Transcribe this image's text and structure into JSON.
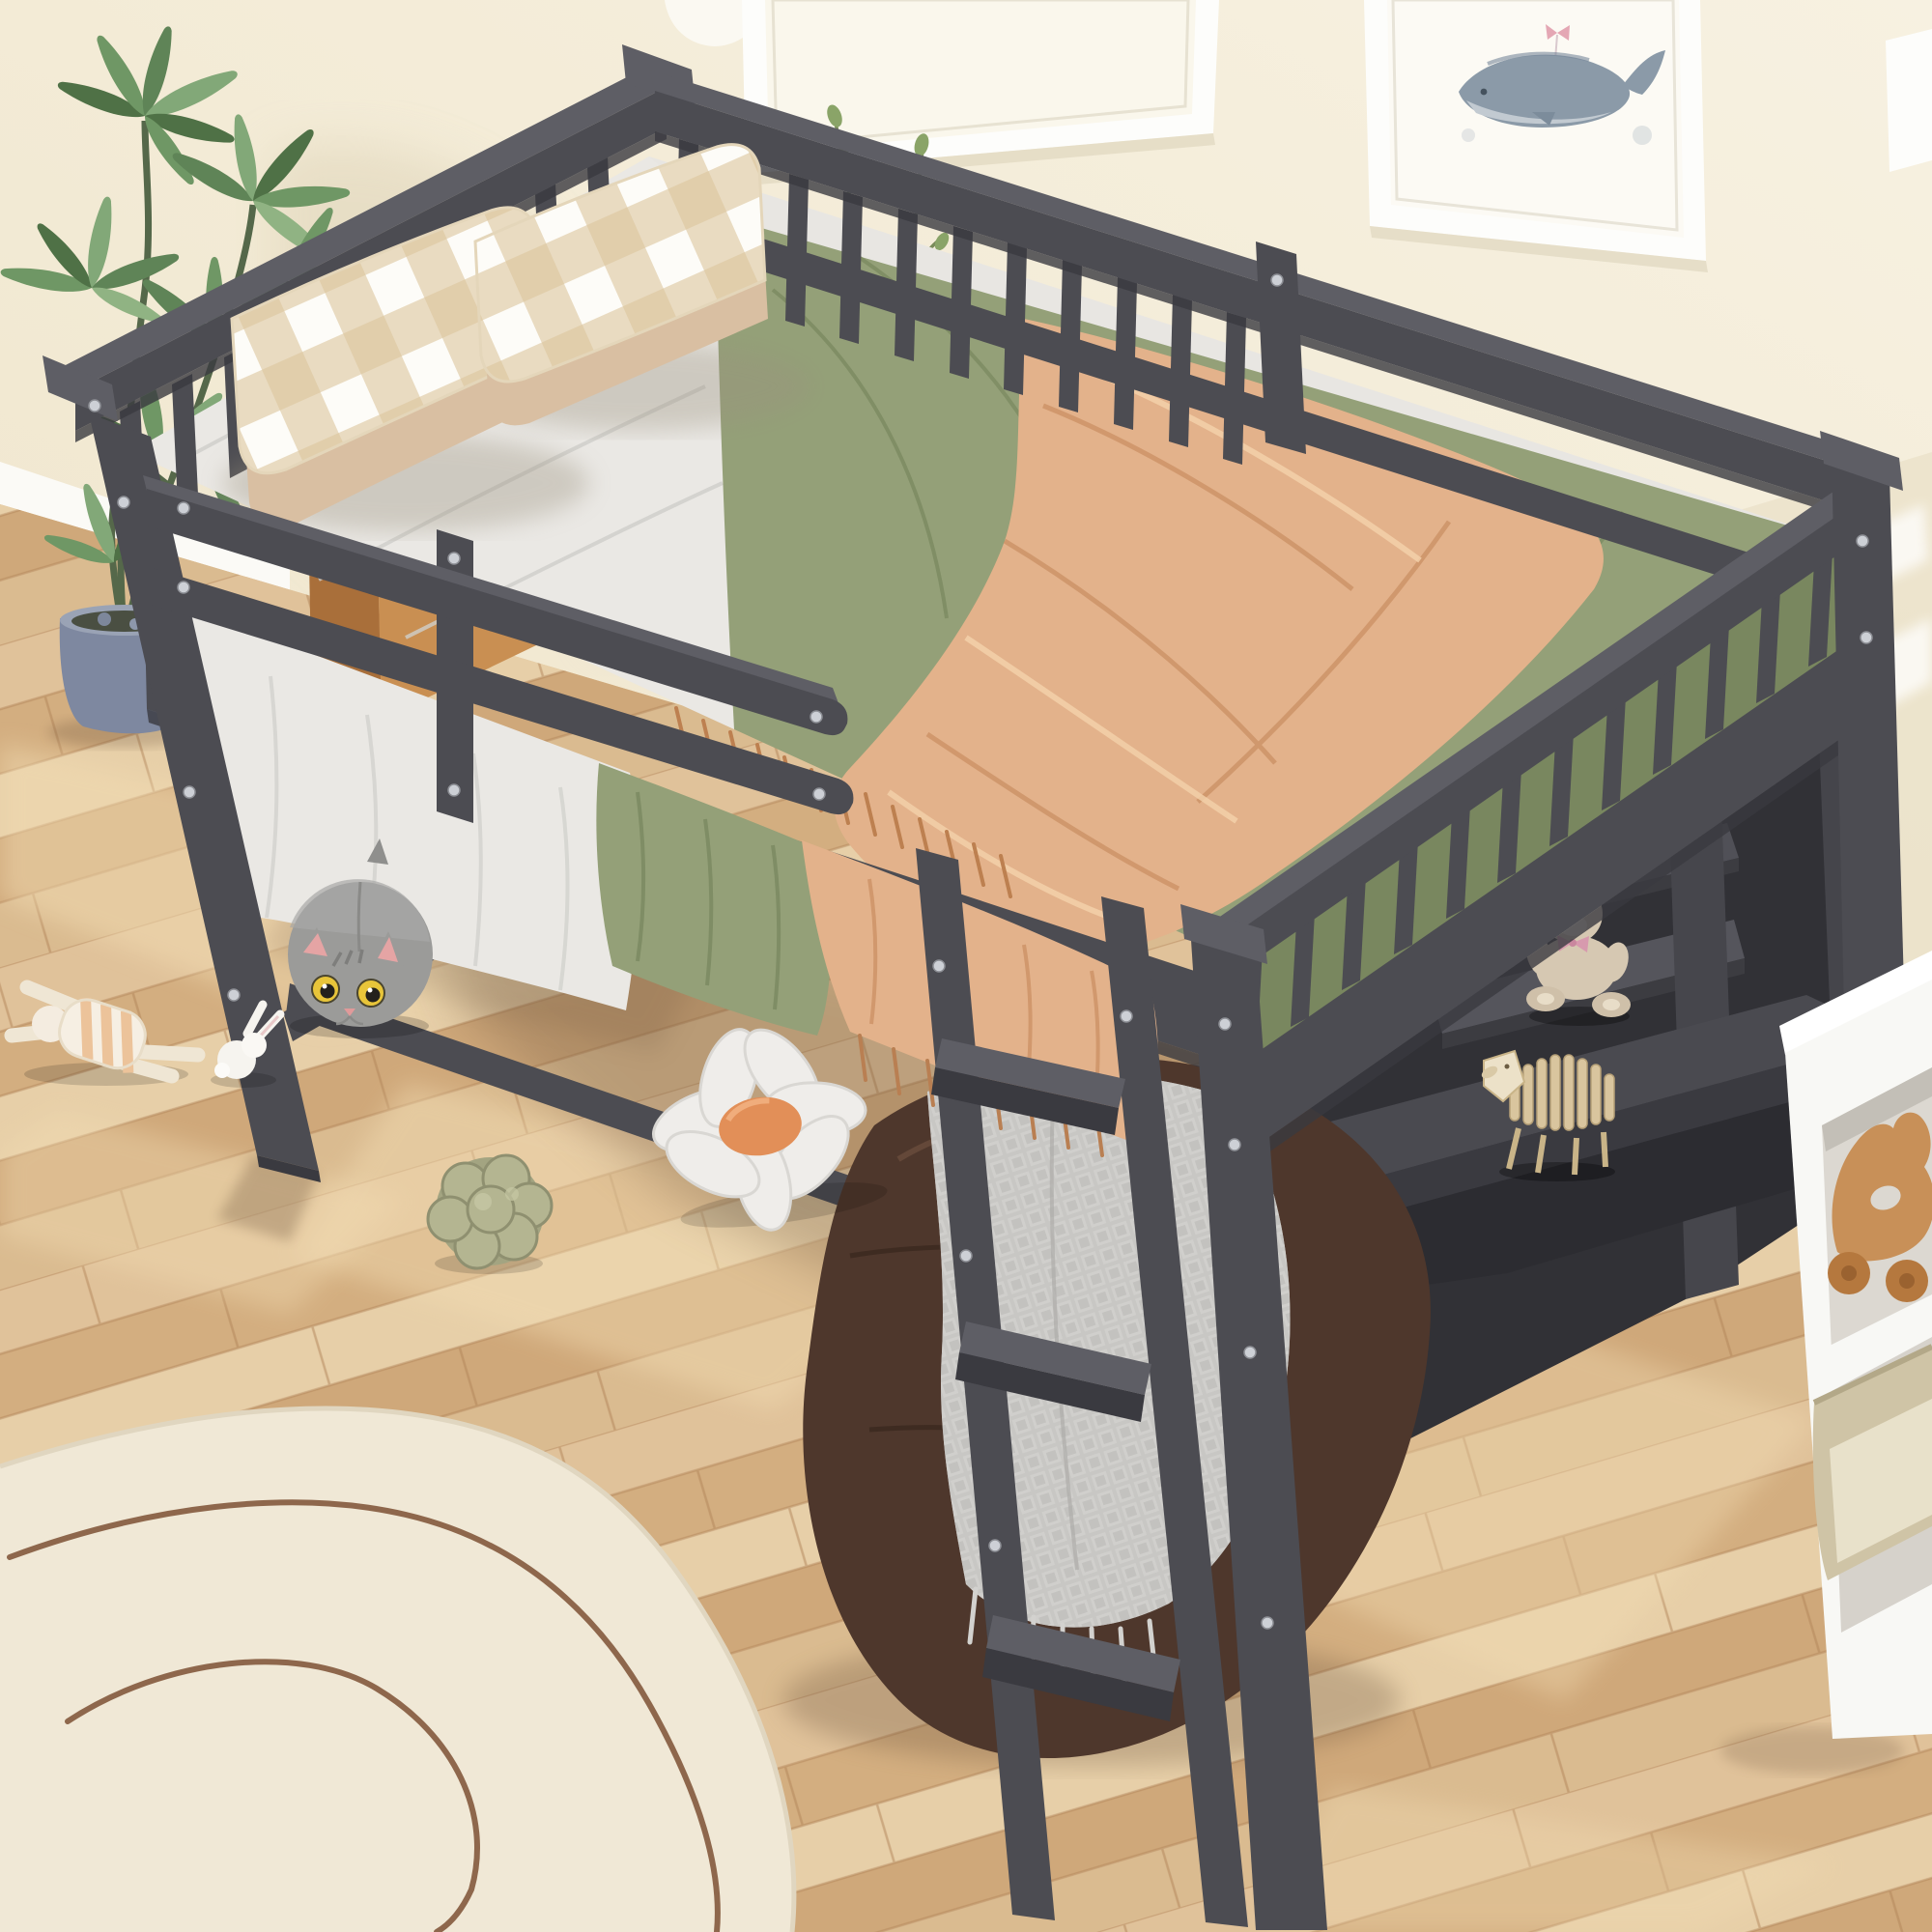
{
  "meta": {
    "domain": "natural-image",
    "description": "Product lifestyle photo: gray wooden full-size loft bed with slatted guardrails, front ladder, under-bed storage shelves and desk, styled in a child's bedroom with toys",
    "visible_text": []
  },
  "palette": {
    "wall": "#f4edda",
    "wall_shadow": "#ddd2b6",
    "baseboard": "#fbfaf6",
    "floor_base": "#d9b98c",
    "floor_light": "#f2dcb2",
    "plank_seam": "#b18457",
    "bed_frame": "#4c4c52",
    "bed_frame_dark": "#3a3a40",
    "bed_frame_light": "#5e5e65",
    "mattress_white": "#eae8e4",
    "sheet_green": "#94a078",
    "sheet_green_dark": "#79875f",
    "blanket_peach": "#e3b28b",
    "pillow_tan": "#d9bfa2",
    "gingham_tan": "#dcc49c",
    "rug": "#f0e8d6",
    "rug_line": "#7d5034",
    "pot": "#7e88a0",
    "leaf": "#5f8457",
    "bean_bag": "#4e372c",
    "blanket_gray": "#c7c6c3",
    "teddy": "#d6c8b2",
    "sheep": "#d9c59e",
    "wood_toy": "#c89058",
    "white_frame": "#fdfdfb",
    "whale": "#8b9aa8",
    "basket": "#cfc4a6",
    "cube_white": "#f8f8f5"
  },
  "scene": {
    "room": {
      "wall": "cream painted wall",
      "floor": "light oak diagonal plank floor with sunlight patches",
      "baseboard": "white baseboard left and right"
    },
    "wall_art": [
      {
        "name": "blank-frame",
        "content": "white frame, blank print, cropped by top edge"
      },
      {
        "name": "whale-frame",
        "content": "watercolor whale hanging from a pink bow"
      }
    ],
    "furniture": {
      "loft_bed": {
        "color": "gray",
        "features": [
          "slatted safety guardrails on all sides",
          "low double-bar front guardrail",
          "built-in ladder with three steps",
          "under-bed storage shelves",
          "built-in desk surface"
        ]
      },
      "nightstand": "wooden nightstand behind head rail with books and glass vase",
      "cube_storage": "white cube storage unit at right edge"
    },
    "bedding": {
      "sheet_left": "white rumpled sheet",
      "fitted_sheet": "sage green",
      "throw_blanket": "peach fleece with fringe draping over front edge",
      "pillows": [
        "tan buffalo-check gingham pillow x2",
        "solid tan pillow x2"
      ]
    },
    "toys_and_decor": [
      "gray cat plush with yellow eyes",
      "white bunny plush",
      "striped rag doll",
      "sage green knot ball pillow",
      "daisy flower pillow with orange center",
      "brown leather bean bag pouf with gray waffle blanket",
      "teddy bear on under-bed shelf",
      "wooden slatted sheep puzzle toy on desk",
      "small wooden arch toy on desk",
      "wooden animal roller toy in cube storage",
      "beige storage basket in cube storage",
      "potted green plant in blue-gray pot",
      "cream organic-shape rug with brown line doodles"
    ]
  }
}
